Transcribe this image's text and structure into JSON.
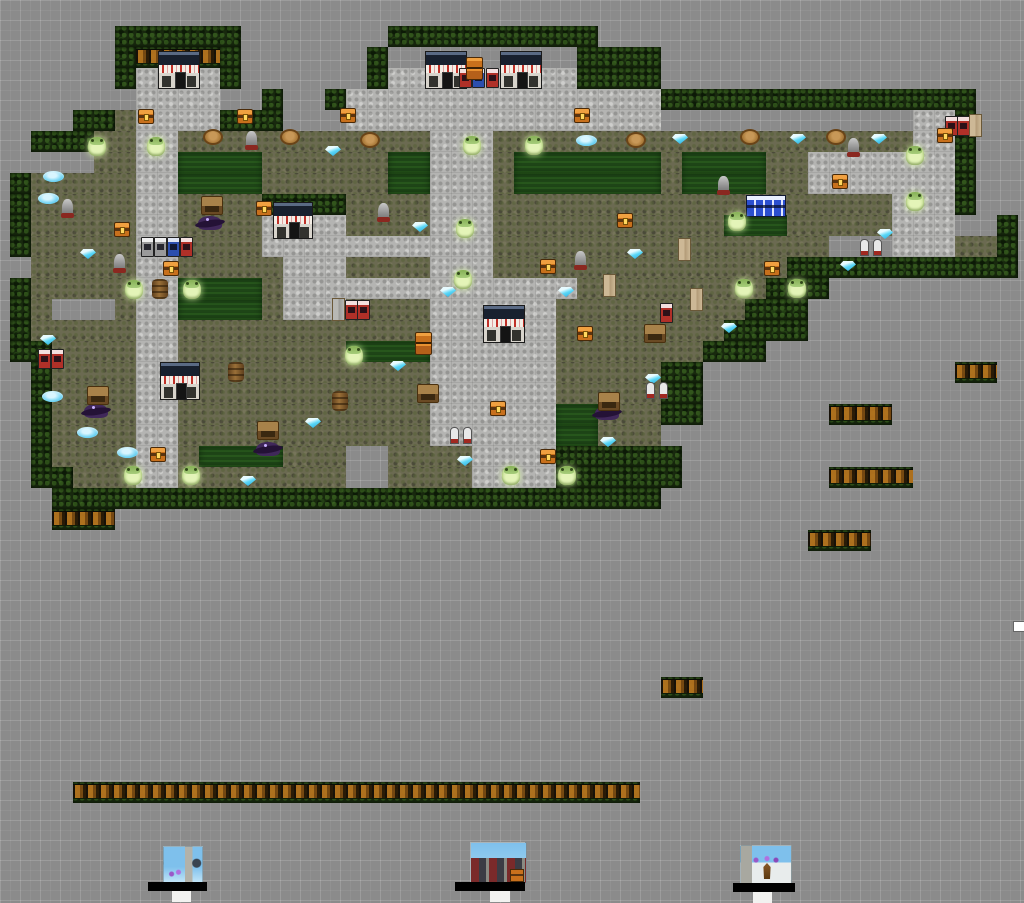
{
  "canvas": {
    "width": 1024,
    "height": 631,
    "background": "#8b8b8b",
    "grid_minor": 10,
    "grid_major": 20
  },
  "map": {
    "origin_x": 10,
    "origin_y": 26,
    "tile_w": 21,
    "tile_h": 21,
    "cols": 48,
    "rows_count": 24,
    "legend": {
      "H": "hedge",
      "C": "hedge-crates",
      "g": "grass",
      "L": "lawn",
      "p": "path",
      ".": "empty"
    },
    "rows": [
      ".....HHHHHH.......HHHHHHHHHH....................",
      ".....HCCCCH......HCCCCCCCCCHHHH.................",
      ".....HppppH......HpppppppppHHHH.................",
      "....CCppppCCH..HpppppppppppppppHHHHHHHHHHHHHHH..",
      "...HHgppppHHHCCCpppppppppppppppCCCCCCCCCCCCppH..",
      ".HHHggppggggggggggggpppggggggggggggggggggggppH..",
      ".CCCggppLLLLggggggLLpppgLLLLLLLgLLLLggpppppppH..",
      "HgggggppLLLLggggggLLpppgLLLLLLLgLLLLggpppppppH..",
      "HgggggppggggHHHHggggpppgggggggggggggggggggpppH..",
      "HgggggppggggppppggggpppgggggggggggLLLgggggpppCCH",
      "HgggggppggggpppppppppppggggggggggggggggCCCpppggH",
      ".gggggppgggggpppggggpppggggggggggggggHHHHHHHHHHH",
      "HgggggppLLLLgppppppppppppppgggggggggHHHCCCC.....",
      "HgCCCgppLLLLgpppggggppppppgggggggggHHHCCC.......",
      "HgggggppggggggggggggppppppggggggggHHHH..........",
      "HHggggppggggggggLLLLppppppgggggggHHH............",
      ".HggggppggggggggggggppppppgggggHH...............",
      ".HggggppggggggggggggppppppgggggHH...............",
      ".HggggppggggggggggggppppppLLgggHH...............",
      ".HggggppggggggggggggppppppLLgggCC...............",
      ".HggggppgLLLLggg..ggggppppHHHHHH................",
      ".HHgggppgggggggg..ggggppppHHHHHH................",
      "..HHHHHHHHHHHHHHHHHHHHHHHHHHHHH.................",
      "...CCCCCCCCCCCCCCCCCCCCCCCCCCC.................."
    ]
  },
  "palette": {
    "hedge": "#18290e",
    "grass": "#6b6a51",
    "lawn": "#1e4517",
    "path": "#b4b4b2",
    "crate": "#b5741f",
    "gem": "#59d7f7",
    "frog": "#cfe79f",
    "chest": "#c8701c",
    "vend_red": "#b03028",
    "vend_blue": "#2c4fae",
    "shop_roof": "#18202e",
    "sign_text": "#c03028"
  },
  "shops": [
    {
      "x": 158,
      "y": 51,
      "w": 42,
      "h": 38
    },
    {
      "x": 425,
      "y": 51,
      "w": 42,
      "h": 38
    },
    {
      "x": 500,
      "y": 51,
      "w": 42,
      "h": 38
    },
    {
      "x": 273,
      "y": 202,
      "w": 40,
      "h": 37
    },
    {
      "x": 483,
      "y": 305,
      "w": 42,
      "h": 38
    },
    {
      "x": 160,
      "y": 362,
      "w": 40,
      "h": 38
    }
  ],
  "sprites": [
    {
      "t": "vend",
      "v": "red",
      "x": 459,
      "y": 68
    },
    {
      "t": "vend",
      "v": "red",
      "x": 486,
      "y": 68
    },
    {
      "t": "vend",
      "v": "blue",
      "x": 472,
      "y": 68
    },
    {
      "t": "vend",
      "v": "red",
      "x": 945,
      "y": 116
    },
    {
      "t": "vend",
      "v": "red",
      "x": 957,
      "y": 116
    },
    {
      "t": "vend",
      "v": "gray",
      "x": 141,
      "y": 237
    },
    {
      "t": "vend",
      "v": "gray",
      "x": 154,
      "y": 237
    },
    {
      "t": "vend",
      "v": "blue",
      "x": 167,
      "y": 237
    },
    {
      "t": "vend",
      "v": "red",
      "x": 180,
      "y": 237
    },
    {
      "t": "vend",
      "v": "red",
      "x": 345,
      "y": 300
    },
    {
      "t": "vend",
      "v": "red",
      "x": 357,
      "y": 300
    },
    {
      "t": "vend",
      "v": "red",
      "x": 660,
      "y": 303
    },
    {
      "t": "vend",
      "v": "red",
      "x": 38,
      "y": 349
    },
    {
      "t": "vend",
      "v": "red",
      "x": 51,
      "y": 349
    },
    {
      "t": "door",
      "v": "beige",
      "x": 969,
      "y": 114
    },
    {
      "t": "door",
      "v": "beige",
      "x": 678,
      "y": 238
    },
    {
      "t": "door",
      "v": "beige",
      "x": 690,
      "y": 288
    },
    {
      "t": "door",
      "v": "beige",
      "x": 603,
      "y": 274
    },
    {
      "t": "door",
      "v": "gray",
      "x": 332,
      "y": 298
    },
    {
      "t": "bluerow",
      "x": 746,
      "y": 195
    },
    {
      "t": "crate2",
      "x": 466,
      "y": 57
    },
    {
      "t": "crate2",
      "x": 415,
      "y": 332
    },
    {
      "t": "chest",
      "x": 138,
      "y": 109
    },
    {
      "t": "chest",
      "x": 237,
      "y": 109
    },
    {
      "t": "chest",
      "x": 340,
      "y": 108
    },
    {
      "t": "chest",
      "x": 574,
      "y": 108
    },
    {
      "t": "chest",
      "x": 937,
      "y": 128
    },
    {
      "t": "chest",
      "x": 832,
      "y": 174
    },
    {
      "t": "chest",
      "x": 114,
      "y": 222
    },
    {
      "t": "chest",
      "x": 256,
      "y": 201
    },
    {
      "t": "chest",
      "x": 163,
      "y": 261
    },
    {
      "t": "chest",
      "x": 617,
      "y": 213
    },
    {
      "t": "chest",
      "x": 540,
      "y": 259
    },
    {
      "t": "chest",
      "x": 577,
      "y": 326
    },
    {
      "t": "chest",
      "x": 764,
      "y": 261
    },
    {
      "t": "chest",
      "x": 150,
      "y": 447
    },
    {
      "t": "chest",
      "x": 490,
      "y": 401
    },
    {
      "t": "chest",
      "x": 540,
      "y": 449
    },
    {
      "t": "frog",
      "x": 88,
      "y": 137
    },
    {
      "t": "frog",
      "x": 147,
      "y": 137
    },
    {
      "t": "frog",
      "x": 463,
      "y": 136
    },
    {
      "t": "frog",
      "x": 525,
      "y": 136
    },
    {
      "t": "frog",
      "x": 906,
      "y": 146
    },
    {
      "t": "frog",
      "x": 728,
      "y": 212
    },
    {
      "t": "frog",
      "x": 456,
      "y": 219
    },
    {
      "t": "frog",
      "x": 906,
      "y": 192
    },
    {
      "t": "frog",
      "x": 125,
      "y": 280
    },
    {
      "t": "frog",
      "x": 183,
      "y": 280
    },
    {
      "t": "frog",
      "x": 454,
      "y": 270
    },
    {
      "t": "frog",
      "x": 735,
      "y": 279
    },
    {
      "t": "frog",
      "x": 788,
      "y": 279
    },
    {
      "t": "frog",
      "x": 345,
      "y": 346
    },
    {
      "t": "frog",
      "x": 124,
      "y": 466
    },
    {
      "t": "frog",
      "x": 182,
      "y": 466
    },
    {
      "t": "frog",
      "x": 502,
      "y": 466
    },
    {
      "t": "frog",
      "x": 558,
      "y": 466
    },
    {
      "t": "gem",
      "x": 325,
      "y": 146
    },
    {
      "t": "gem",
      "x": 672,
      "y": 134
    },
    {
      "t": "gem",
      "x": 790,
      "y": 134
    },
    {
      "t": "gem",
      "x": 871,
      "y": 134
    },
    {
      "t": "gem",
      "x": 80,
      "y": 249
    },
    {
      "t": "gem",
      "x": 40,
      "y": 335
    },
    {
      "t": "gem",
      "x": 412,
      "y": 222
    },
    {
      "t": "gem",
      "x": 440,
      "y": 287
    },
    {
      "t": "gem",
      "x": 558,
      "y": 287
    },
    {
      "t": "gem",
      "x": 627,
      "y": 249
    },
    {
      "t": "gem",
      "x": 390,
      "y": 361
    },
    {
      "t": "gem",
      "x": 840,
      "y": 261
    },
    {
      "t": "gem",
      "x": 877,
      "y": 229
    },
    {
      "t": "gem",
      "x": 721,
      "y": 323
    },
    {
      "t": "gem",
      "x": 305,
      "y": 418
    },
    {
      "t": "gem",
      "x": 240,
      "y": 476
    },
    {
      "t": "gem",
      "x": 600,
      "y": 437
    },
    {
      "t": "gem",
      "x": 645,
      "y": 374
    },
    {
      "t": "gem",
      "x": 457,
      "y": 456
    },
    {
      "t": "puddle",
      "x": 43,
      "y": 171
    },
    {
      "t": "puddle",
      "x": 576,
      "y": 135
    },
    {
      "t": "puddle",
      "x": 42,
      "y": 391
    },
    {
      "t": "puddle",
      "x": 77,
      "y": 427
    },
    {
      "t": "puddle",
      "x": 117,
      "y": 447
    },
    {
      "t": "puddle",
      "x": 38,
      "y": 193
    },
    {
      "t": "stump",
      "x": 203,
      "y": 129
    },
    {
      "t": "stump",
      "x": 280,
      "y": 129
    },
    {
      "t": "stump",
      "x": 360,
      "y": 132
    },
    {
      "t": "stump",
      "x": 626,
      "y": 132
    },
    {
      "t": "stump",
      "x": 740,
      "y": 129
    },
    {
      "t": "stump",
      "x": 826,
      "y": 129
    },
    {
      "t": "urn",
      "x": 246,
      "y": 131
    },
    {
      "t": "urn",
      "x": 62,
      "y": 199
    },
    {
      "t": "urn",
      "x": 114,
      "y": 254
    },
    {
      "t": "urn",
      "x": 848,
      "y": 138
    },
    {
      "t": "urn",
      "x": 378,
      "y": 203
    },
    {
      "t": "urn",
      "x": 575,
      "y": 251
    },
    {
      "t": "urn",
      "x": 718,
      "y": 176
    },
    {
      "t": "barrel",
      "x": 152,
      "y": 279
    },
    {
      "t": "barrel",
      "x": 228,
      "y": 362
    },
    {
      "t": "barrel",
      "x": 332,
      "y": 391
    },
    {
      "t": "bat",
      "x": 198,
      "y": 216
    },
    {
      "t": "bat",
      "x": 84,
      "y": 404
    },
    {
      "t": "bat",
      "x": 256,
      "y": 442
    },
    {
      "t": "bat",
      "x": 595,
      "y": 406
    },
    {
      "t": "bench",
      "x": 201,
      "y": 196
    },
    {
      "t": "bench",
      "x": 87,
      "y": 386
    },
    {
      "t": "bench",
      "x": 257,
      "y": 421
    },
    {
      "t": "bench",
      "x": 417,
      "y": 384
    },
    {
      "t": "bench",
      "x": 598,
      "y": 392
    },
    {
      "t": "bench",
      "x": 644,
      "y": 324
    },
    {
      "t": "gravepair",
      "x": 450,
      "y": 427
    },
    {
      "t": "gravepair",
      "x": 646,
      "y": 382
    },
    {
      "t": "gravepair",
      "x": 860,
      "y": 239
    }
  ],
  "decals": [
    {
      "theme": "garden",
      "img": {
        "x": 163,
        "y": 552,
        "w": 38,
        "h": 36
      },
      "bar": {
        "x": 148,
        "y": 588,
        "w": 59,
        "h": 9
      },
      "stub": {
        "x": 172,
        "y": 597,
        "w": 19,
        "h": 11
      }
    },
    {
      "theme": "arcade",
      "img": {
        "x": 470,
        "y": 548,
        "w": 55,
        "h": 40
      },
      "bar": {
        "x": 455,
        "y": 588,
        "w": 70,
        "h": 9
      },
      "stub": {
        "x": 490,
        "y": 597,
        "w": 20,
        "h": 11
      },
      "chest": {
        "x": 40,
        "y": 27
      }
    },
    {
      "theme": "tower",
      "img": {
        "x": 740,
        "y": 551,
        "w": 50,
        "h": 37
      },
      "bar": {
        "x": 733,
        "y": 589,
        "w": 62,
        "h": 9
      },
      "stub": {
        "x": 753,
        "y": 598,
        "w": 19,
        "h": 11
      }
    }
  ],
  "corner_box": {
    "x": 1013,
    "y": 621,
    "w": 10,
    "h": 9
  }
}
